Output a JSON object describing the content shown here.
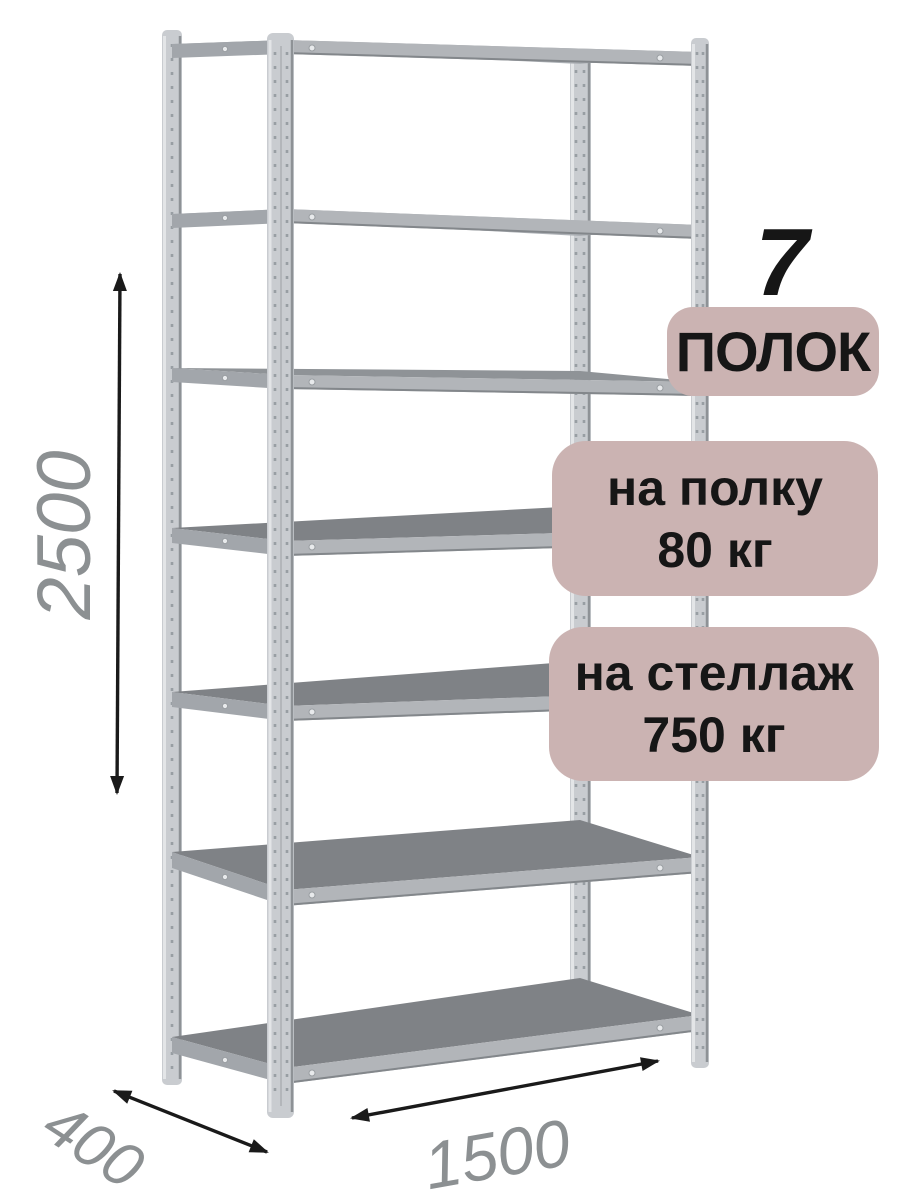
{
  "product_annotations": {
    "shelf_count": {
      "number": "7",
      "label": "ПОЛОК"
    },
    "load_per_shelf": {
      "line1": "на полку",
      "line2": "80 кг"
    },
    "load_per_rack": {
      "line1": "на стеллаж",
      "line2": "750 кг"
    },
    "dimensions": {
      "height": "2500",
      "depth": "400",
      "width": "1500"
    }
  },
  "colors": {
    "badge_bg": "#cbb3b2",
    "badge_text": "#161616",
    "dimension_text": "#8c9092",
    "arrow": "#1a1a1a",
    "metal_light": "#c9ccd0",
    "metal_edge_light": "#e3e5e7",
    "metal_edge_dark": "#8e9296",
    "shelf_top_dark": "#7f8286",
    "shelf_front": "#b2b5b9"
  }
}
